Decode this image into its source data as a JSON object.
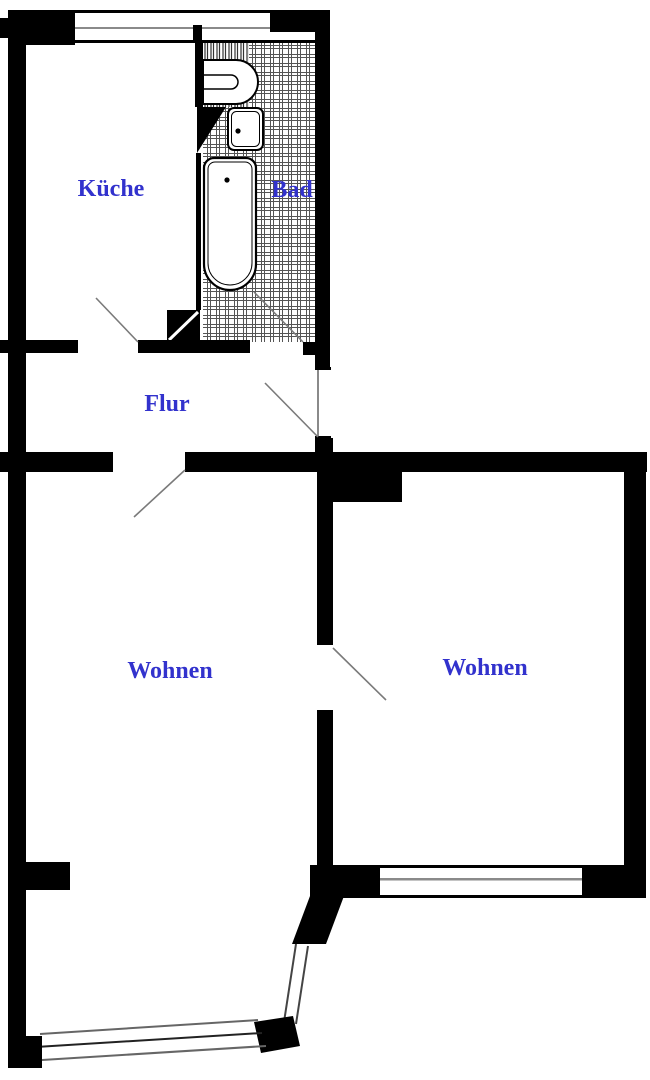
{
  "plan": {
    "title": "apartment-floor-plan",
    "rooms": [
      {
        "id": "kueche",
        "label": "Küche"
      },
      {
        "id": "bad",
        "label": "Bad"
      },
      {
        "id": "flur",
        "label": "Flur"
      },
      {
        "id": "wohnen-left",
        "label": "Wohnen"
      },
      {
        "id": "wohnen-right",
        "label": "Wohnen"
      }
    ],
    "fixtures": [
      {
        "id": "bathtub",
        "name": "bathtub-icon"
      },
      {
        "id": "washbasin",
        "name": "washbasin-icon"
      },
      {
        "id": "toilet",
        "name": "toilet-icon"
      },
      {
        "id": "chimney",
        "name": "chimney-block"
      }
    ],
    "doors": [
      {
        "id": "door-kueche",
        "connects": "Flur-Küche"
      },
      {
        "id": "door-bad",
        "connects": "Flur-Bad"
      },
      {
        "id": "door-kueche-bad",
        "connects": "Küche-Bad"
      },
      {
        "id": "door-wohnen-left",
        "connects": "Flur-Wohnen"
      },
      {
        "id": "door-wohnen-right",
        "connects": "Wohnen-Wohnen"
      },
      {
        "id": "door-entry",
        "connects": "Flur-outside"
      }
    ],
    "colors": {
      "wall": "#000000",
      "background": "#ffffff",
      "room_label": "#3232CD",
      "door_swing": "#7a7a7a",
      "glazing_line": "#8a8a8a",
      "tile_line": "#555555"
    }
  }
}
